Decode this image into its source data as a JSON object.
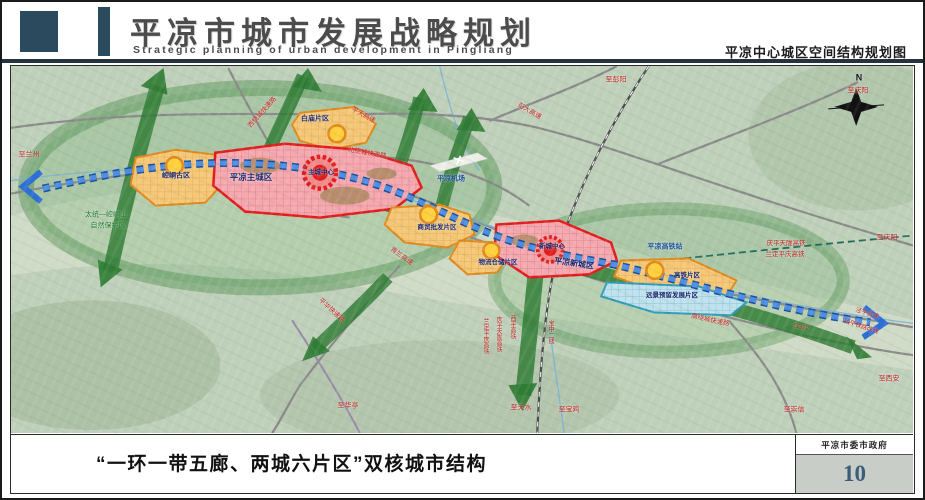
{
  "header": {
    "title": "平凉市城市发展战略规划",
    "subtitle": "Strategic planning of urban development in Pingliang",
    "map_name": "平凉中心城区空间结构规划图"
  },
  "footer": {
    "caption": "“一环一带五廊、两城六片区”双核城市结构",
    "org": "平凉市委市政府",
    "page": "10"
  },
  "colors": {
    "accent_dark": "#2b4a5e",
    "axis_blue": "#2d6fd6",
    "corridor_green": "#2e7b33",
    "core_red": "#e21c1c",
    "zone_pink": "#f4a9b0",
    "zone_orange": "#f5c878",
    "zone_blue": "#bfe2ee",
    "node_yellow": "#ffcf3d",
    "page_number": "#3b5c7a"
  },
  "map": {
    "labels": [
      {
        "t": "N",
        "x": 848,
        "y": 12,
        "c": "#111111",
        "s": 9,
        "b": true
      },
      {
        "t": "至兰州",
        "x": 18,
        "y": 89,
        "c": "#c21f1f",
        "s": 7
      },
      {
        "t": "西绕城快速路",
        "x": 252,
        "y": 47,
        "c": "#c21f1f",
        "s": 6.5,
        "r": -48
      },
      {
        "t": "平天高速",
        "x": 352,
        "y": 50,
        "c": "#c21f1f",
        "s": 6.5,
        "r": 28
      },
      {
        "t": "彭大高速",
        "x": 518,
        "y": 46,
        "c": "#c21f1f",
        "s": 6.5,
        "r": 30
      },
      {
        "t": "至彭阳",
        "x": 605,
        "y": 14,
        "c": "#c21f1f",
        "s": 7
      },
      {
        "t": "至庆阳",
        "x": 847,
        "y": 25,
        "c": "#c21f1f",
        "s": 7
      },
      {
        "t": "北绕城快速路",
        "x": 356,
        "y": 88,
        "c": "#c21f1f",
        "s": 6.5,
        "r": 10
      },
      {
        "t": "青兰高速",
        "x": 390,
        "y": 191,
        "c": "#c21f1f",
        "s": 6.5,
        "r": 36
      },
      {
        "t": "平华快速路",
        "x": 320,
        "y": 245,
        "c": "#c21f1f",
        "s": 6.5,
        "r": 42
      },
      {
        "t": "至庆阳",
        "x": 876,
        "y": 172,
        "c": "#c21f1f",
        "s": 7
      },
      {
        "t": "庆平天陇高铁",
        "x": 775,
        "y": 178,
        "c": "#c21f1f",
        "s": 6.5
      },
      {
        "t": "兰定平庆高铁",
        "x": 774,
        "y": 189,
        "c": "#c21f1f",
        "s": 6.5
      },
      {
        "t": "南绕城快速路",
        "x": 699,
        "y": 255,
        "c": "#c21f1f",
        "s": 6.5,
        "r": 12
      },
      {
        "t": "G312",
        "x": 790,
        "y": 262,
        "c": "#c21f1f",
        "s": 6.5,
        "r": 12
      },
      {
        "t": "泾平高速",
        "x": 856,
        "y": 248,
        "c": "#c21f1f",
        "s": 6,
        "r": 18
      },
      {
        "t": "西平铁路改线",
        "x": 850,
        "y": 261,
        "c": "#c21f1f",
        "s": 6,
        "r": 18
      },
      {
        "t": "至西安",
        "x": 878,
        "y": 313,
        "c": "#c21f1f",
        "s": 7
      },
      {
        "t": "至崇信",
        "x": 783,
        "y": 344,
        "c": "#c21f1f",
        "s": 7
      },
      {
        "t": "至华亭",
        "x": 337,
        "y": 340,
        "c": "#c21f1f",
        "s": 7
      },
      {
        "t": "至天水",
        "x": 510,
        "y": 342,
        "c": "#c21f1f",
        "s": 7
      },
      {
        "t": "至宝鸡",
        "x": 558,
        "y": 344,
        "c": "#c21f1f",
        "s": 7
      },
      {
        "t": "兰定平庆高铁",
        "x": 474,
        "y": 270,
        "c": "#c21f1f",
        "s": 6,
        "v": true
      },
      {
        "t": "庆平天陇高铁",
        "x": 487,
        "y": 268,
        "c": "#c21f1f",
        "s": 6,
        "v": true
      },
      {
        "t": "西平高铁",
        "x": 501,
        "y": 261,
        "c": "#c21f1f",
        "s": 6,
        "v": true
      },
      {
        "t": "宝中二线",
        "x": 539,
        "y": 266,
        "c": "#c21f1f",
        "s": 6,
        "v": true
      },
      {
        "t": "平凉机场",
        "x": 440,
        "y": 113,
        "c": "#1a4fa0",
        "s": 7,
        "b": true
      },
      {
        "t": "平凉高铁站",
        "x": 654,
        "y": 181,
        "c": "#1a4fa0",
        "s": 7,
        "b": true
      },
      {
        "t": "太统—崆峒山",
        "x": 95,
        "y": 149,
        "c": "#1e7a30",
        "s": 7
      },
      {
        "t": "自然保护区",
        "x": 97,
        "y": 160,
        "c": "#1e7a30",
        "s": 7
      },
      {
        "t": "崆峒古区",
        "x": 165,
        "y": 110,
        "c": "#16246e",
        "s": 7,
        "b": true
      },
      {
        "t": "平凉主城区",
        "x": 240,
        "y": 111,
        "c": "#16246e",
        "s": 8.5,
        "b": true
      },
      {
        "t": "主城中心",
        "x": 310,
        "y": 107,
        "c": "#16246e",
        "s": 6.5,
        "b": true
      },
      {
        "t": "白庙片区",
        "x": 304,
        "y": 53,
        "c": "#16246e",
        "s": 7,
        "b": true
      },
      {
        "t": "商贸批发片区",
        "x": 426,
        "y": 162,
        "c": "#16246e",
        "s": 6.5,
        "b": true
      },
      {
        "t": "物流仓储片区",
        "x": 487,
        "y": 197,
        "c": "#16246e",
        "s": 6.5,
        "b": true
      },
      {
        "t": "平凉新城区",
        "x": 563,
        "y": 198,
        "c": "#16246e",
        "s": 8,
        "b": true,
        "r": 8
      },
      {
        "t": "新城中心",
        "x": 541,
        "y": 181,
        "c": "#16246e",
        "s": 6.5,
        "b": true
      },
      {
        "t": "高铁片区",
        "x": 676,
        "y": 210,
        "c": "#16246e",
        "s": 6.5,
        "b": true
      },
      {
        "t": "远景预留发展片区",
        "x": 661,
        "y": 230,
        "c": "#16246e",
        "s": 6.5,
        "b": true
      }
    ]
  }
}
